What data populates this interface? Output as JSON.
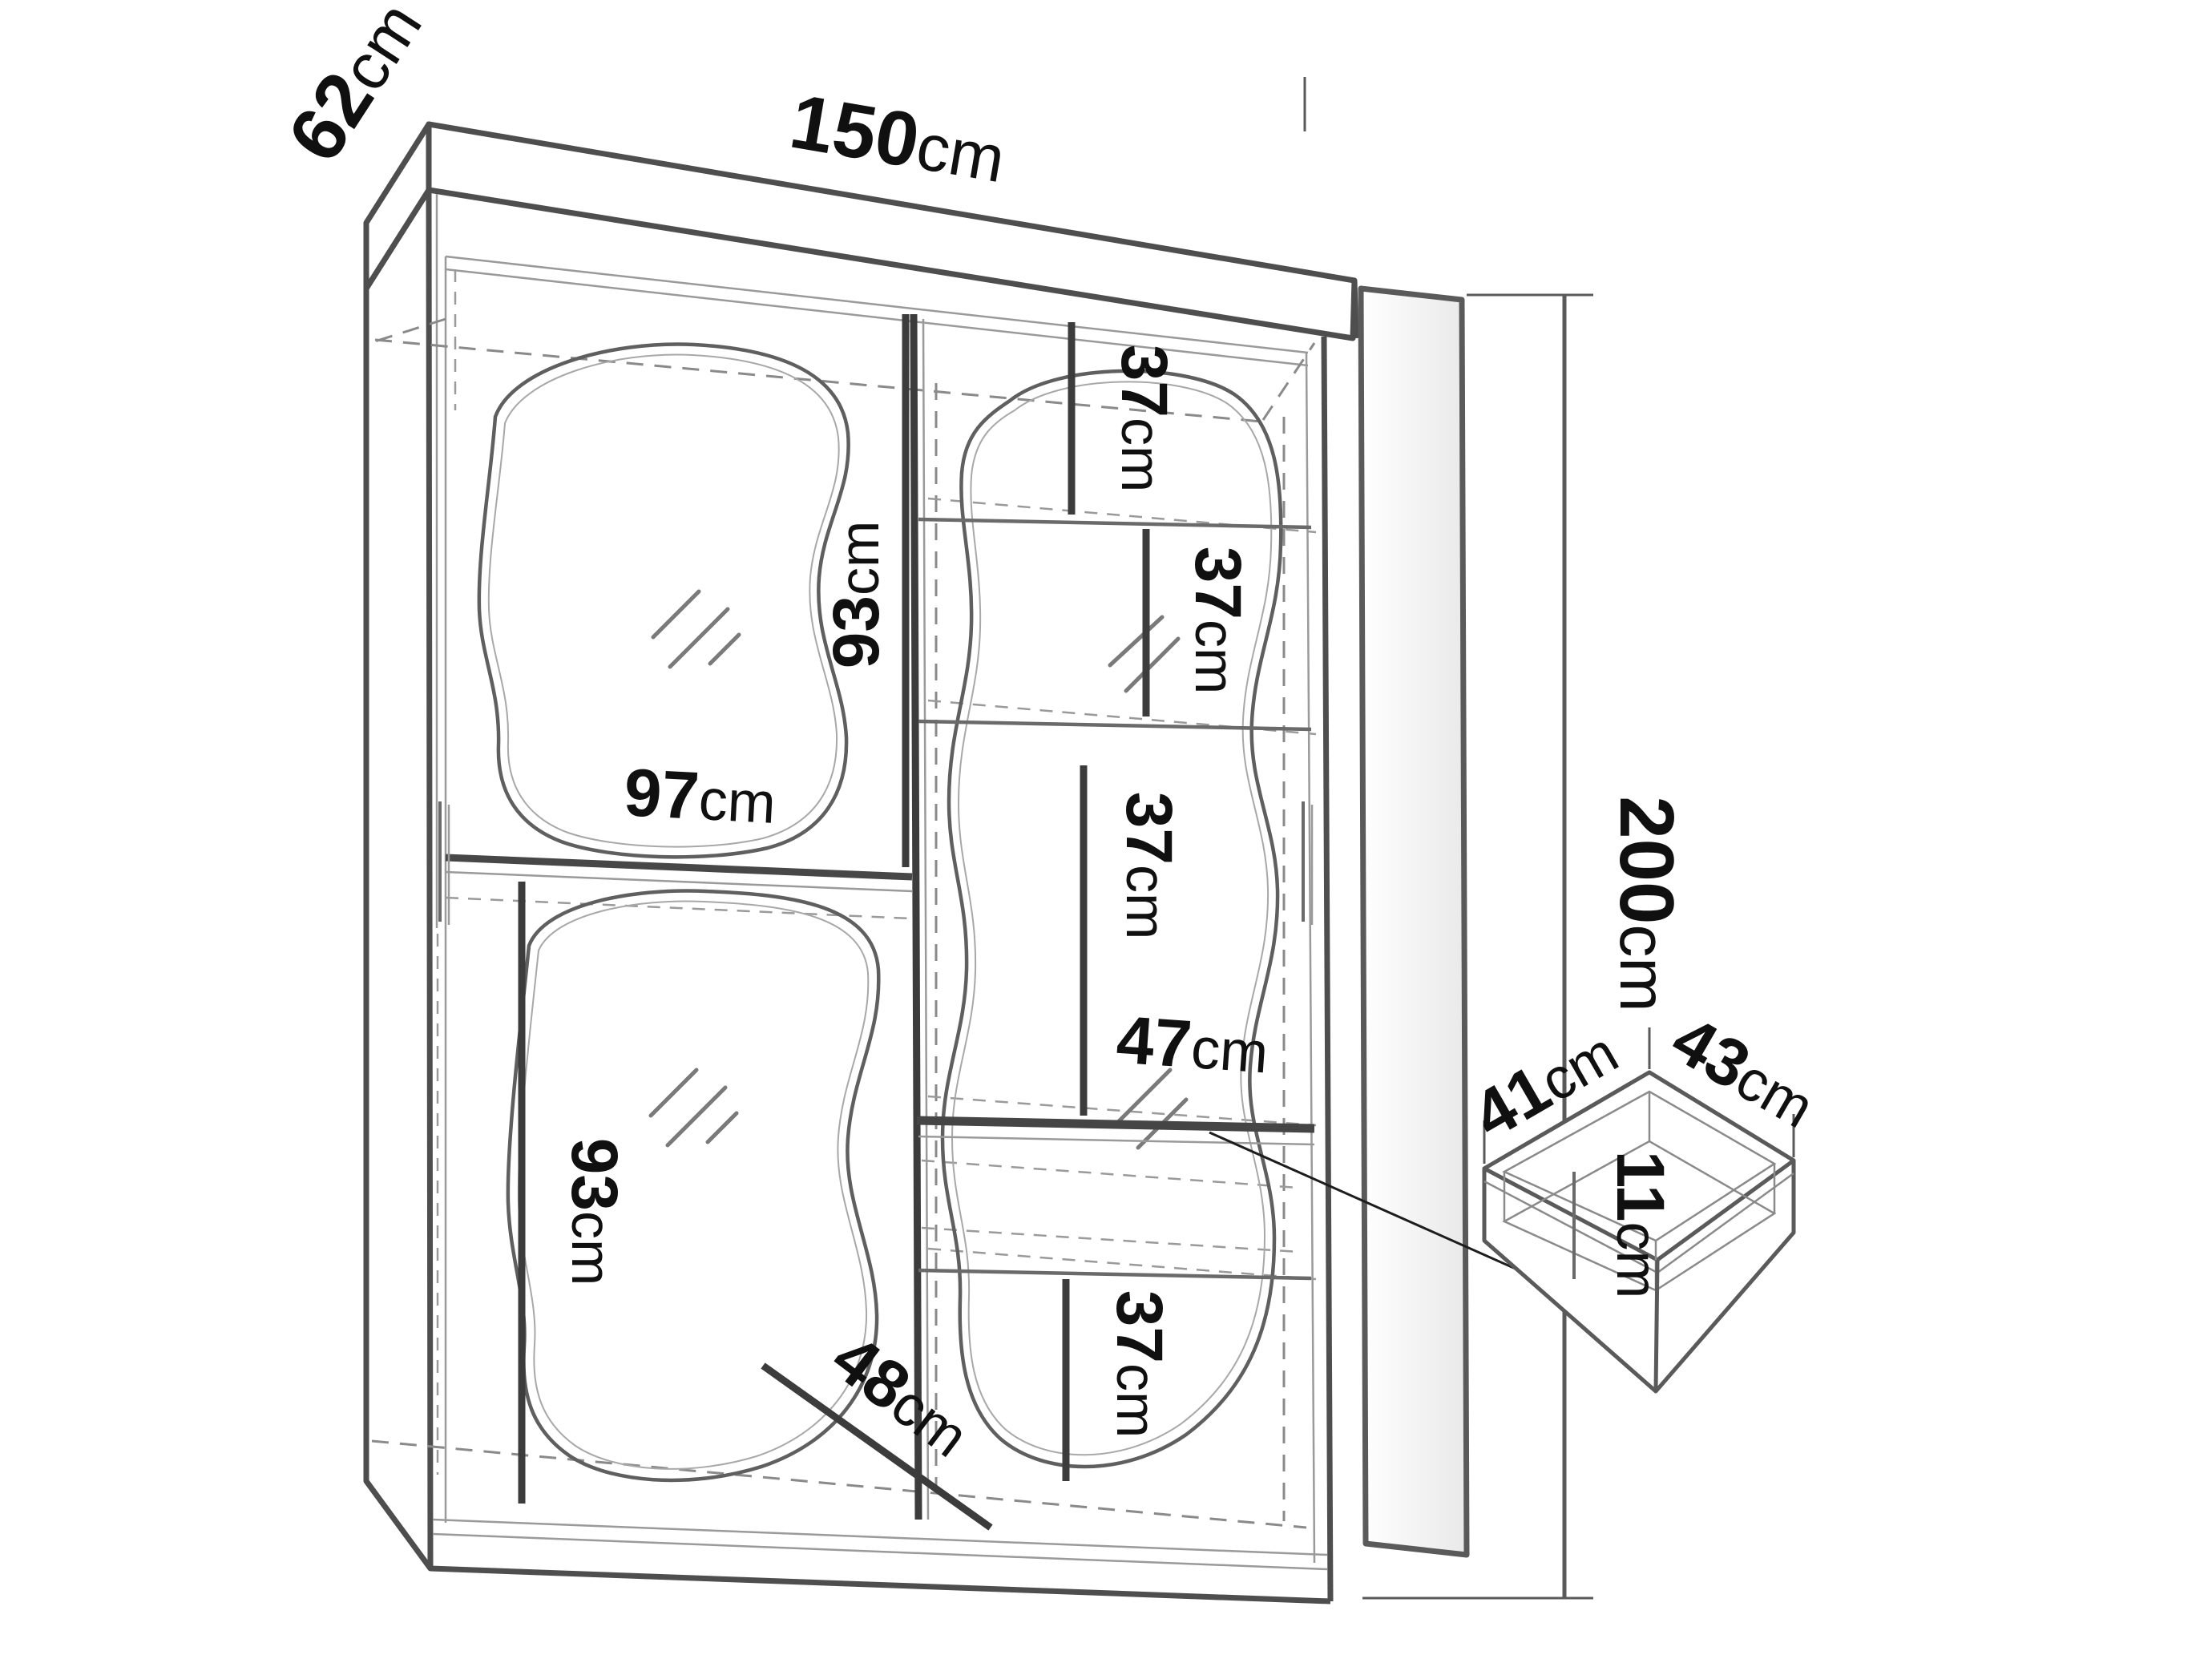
{
  "diagram_type": "wardrobe-dimension-drawing",
  "colors": {
    "background": "#ffffff",
    "line_main": "#4e4e4e",
    "line_dim": "#3c3c3c",
    "line_dashed": "#8a8a8a",
    "text": "#101010"
  },
  "labels": {
    "width": {
      "value": "150",
      "unit": "cm"
    },
    "depth": {
      "value": "62",
      "unit": "cm"
    },
    "height": {
      "value": "200",
      "unit": "cm"
    },
    "rail_width": {
      "value": "97",
      "unit": "cm"
    },
    "mirror_upper": {
      "value": "93",
      "unit": "cm"
    },
    "mirror_lower": {
      "value": "93",
      "unit": "cm"
    },
    "shelf_gap_1": {
      "value": "37",
      "unit": "cm"
    },
    "shelf_gap_2": {
      "value": "37",
      "unit": "cm"
    },
    "shelf_gap_3": {
      "value": "37",
      "unit": "cm"
    },
    "shelf_gap_4": {
      "value": "37",
      "unit": "cm"
    },
    "shelf_width": {
      "value": "47",
      "unit": "cm"
    },
    "base_depth": {
      "value": "48",
      "unit": "cm"
    },
    "drawer_width": {
      "value": "41",
      "unit": "cm"
    },
    "drawer_depth": {
      "value": "43",
      "unit": "cm"
    },
    "drawer_height": {
      "value": "11",
      "unit": "cm"
    }
  }
}
